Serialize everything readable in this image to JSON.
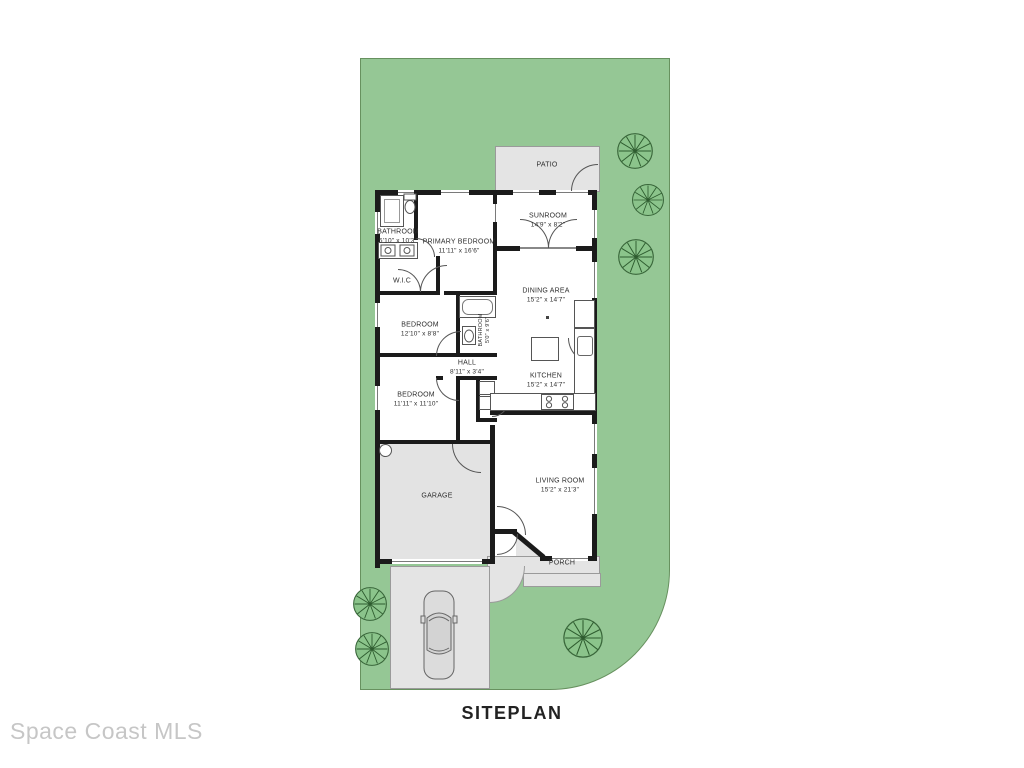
{
  "title": "SITEPLAN",
  "watermark": "Space Coast MLS",
  "colors": {
    "lot_green": "#95c795",
    "lot_border": "#67915f",
    "paving_gray": "#e4e4e4",
    "wall_black": "#1b1b1b",
    "tree_fill": "#8bc48b",
    "tree_stroke": "#2e5c2f",
    "label_text": "#2e2e2e",
    "watermark_gray": "#c6c6c6"
  },
  "rooms": {
    "patio": {
      "name": "PATIO"
    },
    "sunroom": {
      "name": "SUNROOM",
      "dims": "14'9\" x 8'2\""
    },
    "bathroom": {
      "name": "BATHROOM",
      "dims": "5'10\" x 10'3\""
    },
    "primary_bedroom": {
      "name": "PRIMARY BEDROOM",
      "dims": "11'11\" x 16'6\""
    },
    "wic": {
      "name": "W.I.C"
    },
    "dining_area": {
      "name": "DINING AREA",
      "dims": "15'2\" x 14'7\""
    },
    "bedroom_mid": {
      "name": "BEDROOM",
      "dims": "12'10\" x 8'8\""
    },
    "bathroom_hall": {
      "name": "BATHROOM",
      "dims": "5'0\" x 9'6\""
    },
    "hall": {
      "name": "HALL",
      "dims": "8'11\" x 3'4\""
    },
    "kitchen": {
      "name": "KITCHEN",
      "dims": "15'2\" x 14'7\""
    },
    "bedroom_front": {
      "name": "BEDROOM",
      "dims": "11'11\" x 11'10\""
    },
    "garage": {
      "name": "GARAGE"
    },
    "living_room": {
      "name": "LIVING ROOM",
      "dims": "15'2\" x 21'3\""
    },
    "porch": {
      "name": "PORCH"
    }
  }
}
